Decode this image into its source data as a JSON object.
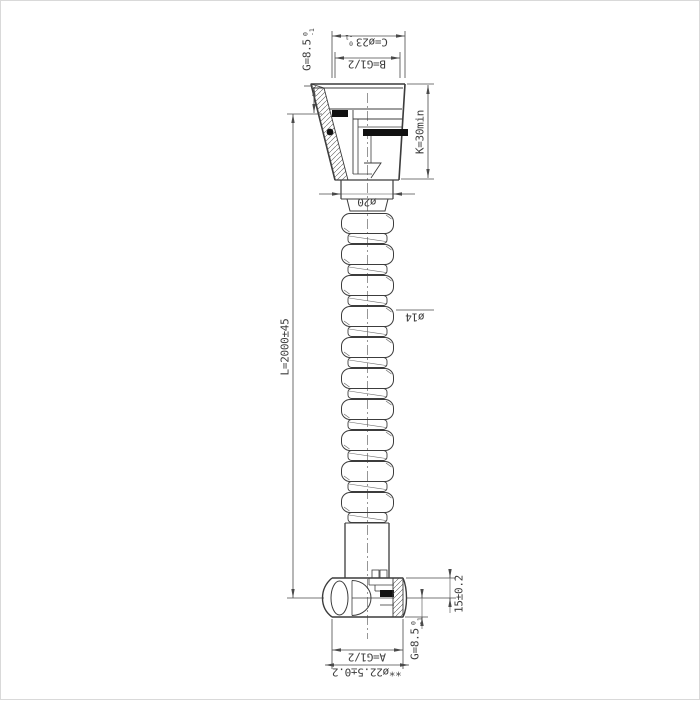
{
  "page": {
    "background": "#ffffff",
    "border_color": "#d9d9d9",
    "geometry_line_color": "#3c3c3c",
    "dimension_line_color": "#4a4a4a",
    "seal_fill_color": "#111111"
  },
  "drawing": {
    "subject": "shower-hose-technical-drawing",
    "labels": {
      "dim_c": {
        "text": "C=ø23",
        "tol_sup": "0",
        "tol_sub": "-1"
      },
      "dim_b": {
        "text": "B=G1/2"
      },
      "dim_g_top": {
        "text": "G=8.5",
        "tol_sup": "0",
        "tol_sub": "-1"
      },
      "dim_k": {
        "text": "K=30min"
      },
      "dim_neck": {
        "text": "ø20"
      },
      "dim_length": {
        "text": "L=2000±45"
      },
      "dim_hose": {
        "text": "ø14"
      },
      "dim_seat": {
        "text": "15±0.2"
      },
      "dim_g_bottom": {
        "text": "G=8.5",
        "tol_sup": "0",
        "tol_sub": "-1"
      },
      "dim_a": {
        "text": "A=G1/2"
      },
      "dim_od": {
        "text": "**ø22.5±0.2"
      }
    }
  }
}
